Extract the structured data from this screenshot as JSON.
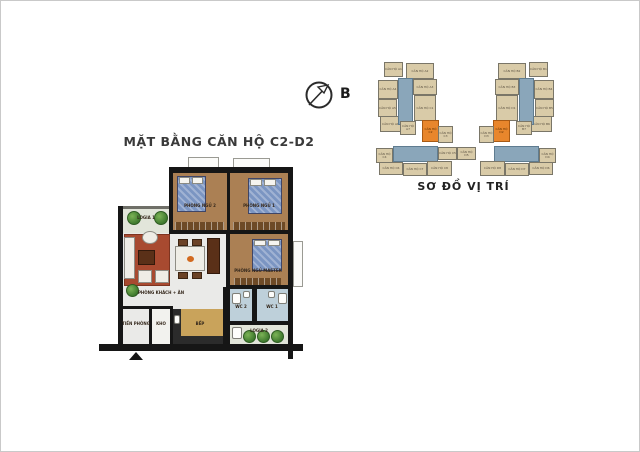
{
  "floor_plan": {
    "title": "MẶT BẰNG CĂN HỘ C2-D2",
    "rooms": [
      {
        "label": "LOGIA 1"
      },
      {
        "label": "PHÒNG NGỦ 2"
      },
      {
        "label": "PHÒNG NGỦ 1"
      },
      {
        "label": "PHÒNG NGỦ MASTER"
      },
      {
        "label": "PHÒNG KHÁCH + ĂN"
      },
      {
        "label": "TIỀN PHÒNG"
      },
      {
        "label": "KHO"
      },
      {
        "label": "BẾP"
      },
      {
        "label": "WC 2"
      },
      {
        "label": "WC 1"
      },
      {
        "label": "LOGIA 2"
      }
    ],
    "colors": {
      "wall": "#161616",
      "bedroom_floor": "#ab8054",
      "bed": "#7b95c2",
      "living_floor": "#eaeae8",
      "rug": "#a84a30",
      "kitchen_floor": "#c9a35b",
      "wc_floor": "#bed0da",
      "tree": "#3f7a2e"
    }
  },
  "compass": {
    "label": "B"
  },
  "site_plan": {
    "title": "SƠ ĐỒ VỊ TRÍ",
    "highlight_color": "#e8862c",
    "unit_color": "#d9cba8",
    "core_color": "#8aa6ba",
    "units": [
      {
        "label": "CĂN HỘ A1",
        "x": 8,
        "y": 6,
        "w": 19,
        "h": 15,
        "type": "tan"
      },
      {
        "label": "CĂN HỘ A2",
        "x": 30,
        "y": 7,
        "w": 28,
        "h": 16,
        "type": "tan"
      },
      {
        "label": "CĂN HỘ A3",
        "x": 37,
        "y": 23,
        "w": 24,
        "h": 16,
        "type": "tan"
      },
      {
        "label": "CĂN HỘ A4",
        "x": 2,
        "y": 24,
        "w": 20,
        "h": 19,
        "type": "tan"
      },
      {
        "label": "CĂN HỘ A5",
        "x": 2,
        "y": 43,
        "w": 19,
        "h": 18,
        "type": "tan"
      },
      {
        "label": "CĂN HỘ A6",
        "x": 4,
        "y": 60,
        "w": 21,
        "h": 16,
        "type": "tan"
      },
      {
        "label": "",
        "x": 22,
        "y": 22,
        "w": 15,
        "h": 47,
        "type": "blue"
      },
      {
        "label": "CĂN HỘ A7",
        "x": 24,
        "y": 65,
        "w": 16,
        "h": 14,
        "type": "tan"
      },
      {
        "label": "CĂN HỘ C1",
        "x": 38,
        "y": 39,
        "w": 22,
        "h": 26,
        "type": "tan"
      },
      {
        "label": "CĂN HỘ C2",
        "x": 46,
        "y": 64,
        "w": 17,
        "h": 22,
        "type": "orange"
      },
      {
        "label": "CĂN HỘ C3",
        "x": 62,
        "y": 70,
        "w": 15,
        "h": 17,
        "type": "tan"
      },
      {
        "label": "",
        "x": 17,
        "y": 90,
        "w": 45,
        "h": 16,
        "type": "blue"
      },
      {
        "label": "CĂN HỘ C4",
        "x": 0,
        "y": 92,
        "w": 17,
        "h": 15,
        "type": "tan"
      },
      {
        "label": "CĂN HỘ C5",
        "x": 62,
        "y": 91,
        "w": 19,
        "h": 13,
        "type": "tan"
      },
      {
        "label": "CĂN HỘ D5",
        "x": 81,
        "y": 91,
        "w": 19,
        "h": 13,
        "type": "tan"
      },
      {
        "label": "CĂN HỘ C6",
        "x": 3,
        "y": 106,
        "w": 24,
        "h": 13,
        "type": "tan"
      },
      {
        "label": "CĂN HỘ C7",
        "x": 27,
        "y": 107,
        "w": 24,
        "h": 13,
        "type": "tan"
      },
      {
        "label": "CĂN HỘ C8",
        "x": 51,
        "y": 105,
        "w": 25,
        "h": 15,
        "type": "tan"
      },
      {
        "label": "CĂN HỘ B1",
        "x": 153,
        "y": 6,
        "w": 19,
        "h": 15,
        "type": "tan"
      },
      {
        "label": "CĂN HỘ B2",
        "x": 122,
        "y": 7,
        "w": 28,
        "h": 16,
        "type": "tan"
      },
      {
        "label": "CĂN HỘ B3",
        "x": 119,
        "y": 23,
        "w": 24,
        "h": 16,
        "type": "tan"
      },
      {
        "label": "CĂN HỘ B4",
        "x": 158,
        "y": 24,
        "w": 20,
        "h": 19,
        "type": "tan"
      },
      {
        "label": "CĂN HỘ B5",
        "x": 159,
        "y": 43,
        "w": 19,
        "h": 18,
        "type": "tan"
      },
      {
        "label": "CĂN HỘ B6",
        "x": 155,
        "y": 60,
        "w": 21,
        "h": 16,
        "type": "tan"
      },
      {
        "label": "",
        "x": 143,
        "y": 22,
        "w": 15,
        "h": 47,
        "type": "blue"
      },
      {
        "label": "CĂN HỘ B7",
        "x": 140,
        "y": 65,
        "w": 16,
        "h": 14,
        "type": "tan"
      },
      {
        "label": "CĂN HỘ D1",
        "x": 120,
        "y": 39,
        "w": 22,
        "h": 26,
        "type": "tan"
      },
      {
        "label": "CĂN HỘ D2",
        "x": 117,
        "y": 64,
        "w": 17,
        "h": 22,
        "type": "orange"
      },
      {
        "label": "CĂN HỘ D3",
        "x": 103,
        "y": 70,
        "w": 15,
        "h": 17,
        "type": "tan"
      },
      {
        "label": "",
        "x": 118,
        "y": 90,
        "w": 45,
        "h": 16,
        "type": "blue"
      },
      {
        "label": "CĂN HỘ D4",
        "x": 163,
        "y": 92,
        "w": 17,
        "h": 15,
        "type": "tan"
      },
      {
        "label": "CĂN HỘ D8",
        "x": 104,
        "y": 105,
        "w": 25,
        "h": 15,
        "type": "tan"
      },
      {
        "label": "CĂN HỘ D7",
        "x": 129,
        "y": 107,
        "w": 24,
        "h": 13,
        "type": "tan"
      },
      {
        "label": "CĂN HỘ D6",
        "x": 153,
        "y": 106,
        "w": 24,
        "h": 13,
        "type": "tan"
      }
    ]
  }
}
